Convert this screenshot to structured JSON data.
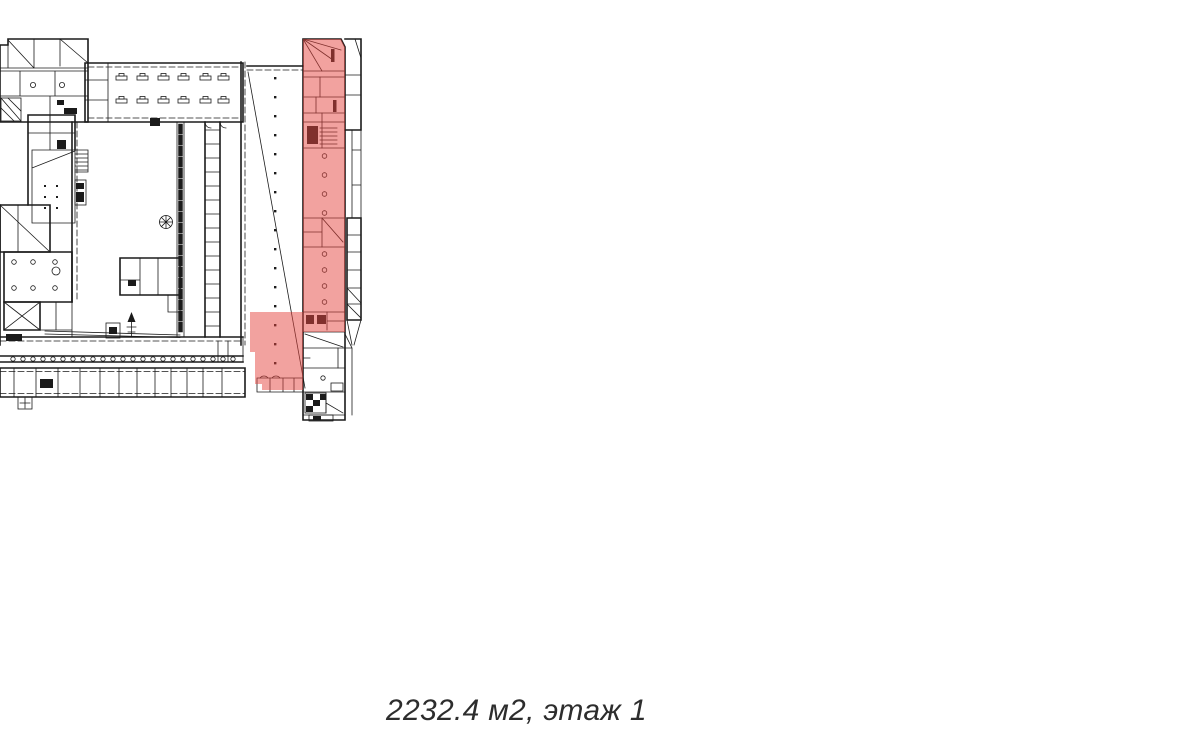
{
  "page": {
    "background": "#ffffff"
  },
  "caption": {
    "text": "2232.4 м2, этаж 1"
  },
  "plan": {
    "type": "building-floor-plan",
    "area_m2": "2232.4",
    "floor_label": "этаж 1",
    "highlight_color": "#e64540",
    "line_color": "#1b1b1b"
  }
}
